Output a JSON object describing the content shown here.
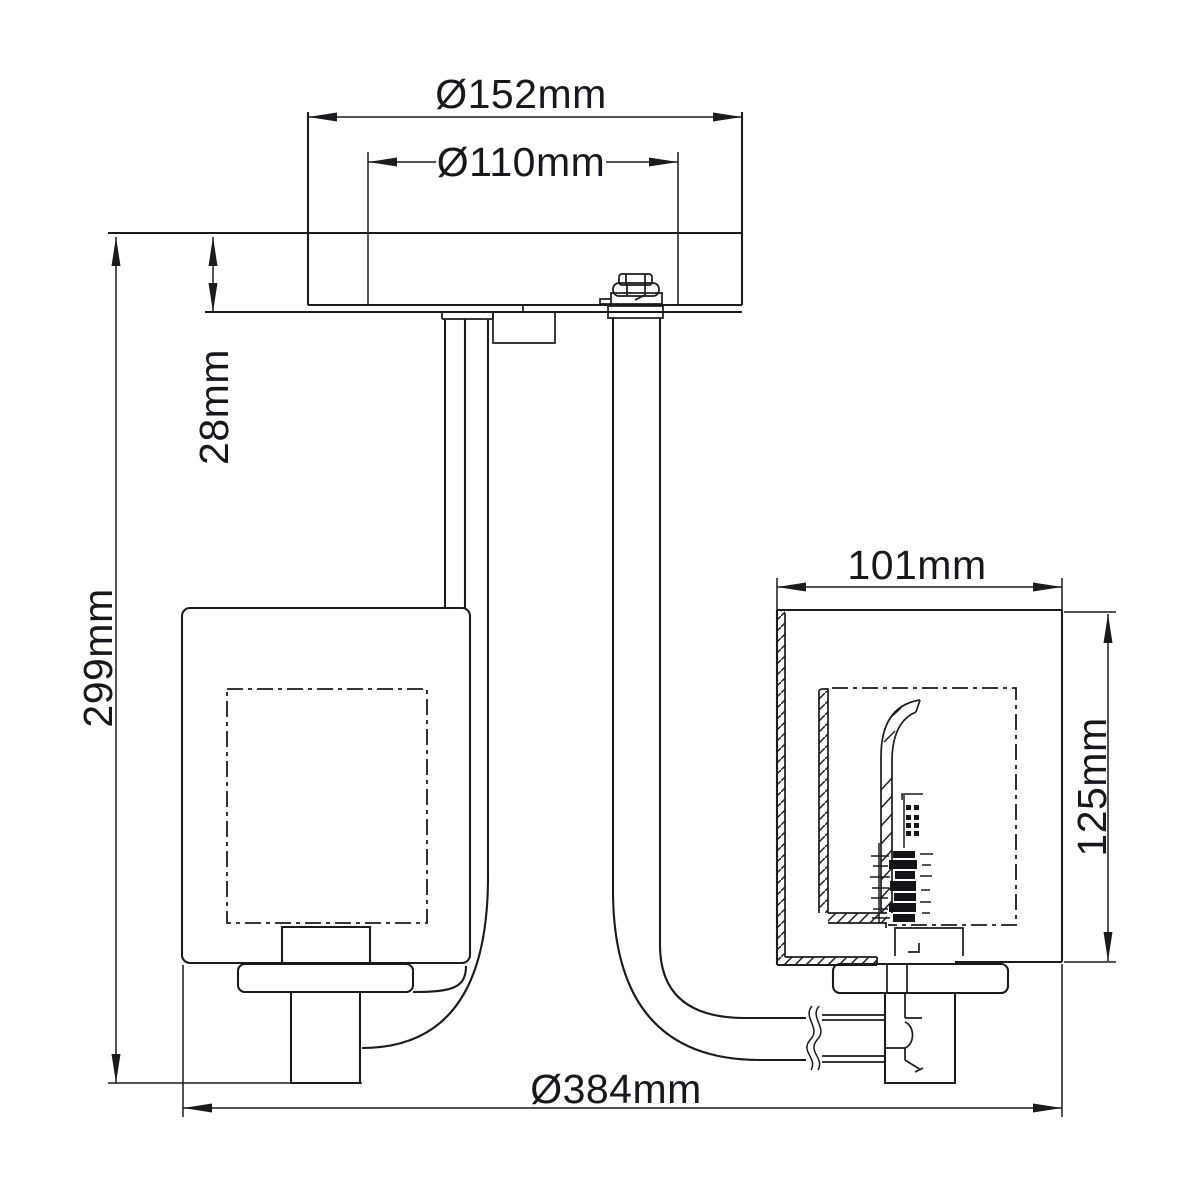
{
  "drawing": {
    "background_color": "#ffffff",
    "line_color": "#1b1b1f",
    "text_color": "#17171d",
    "dimensions": {
      "canopy_diameter": "Ø152mm",
      "canopy_inner_diameter": "Ø110mm",
      "canopy_height": "28mm",
      "overall_height": "299mm",
      "shade_width": "101mm",
      "shade_height": "125mm",
      "overall_width": "Ø384mm"
    }
  }
}
